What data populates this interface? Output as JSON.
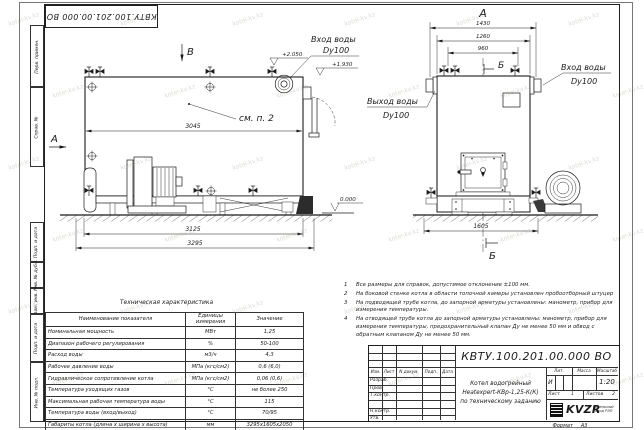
{
  "watermark": "kotel-kv.kz",
  "corner_stamp": "КВТУ.100.201.00.000 ВО",
  "margin_labels": {
    "perv_primen": "Перв. примен.",
    "sprav_no": "Справ. №",
    "podp_data_1": "Подп. и дата",
    "inv_dubl": "Инв. № дубл.",
    "vzam_inv": "Взам. инв. №",
    "podp_data_2": "Подп. и дата",
    "inv_podl": "Инв. № подл."
  },
  "drawing": {
    "left_view": {
      "section_top": "В",
      "section_side": "А",
      "callout": "см. п. 2",
      "dim_width": "3045",
      "dim_base": "3125",
      "dim_total": "3295",
      "level_top": "+2.050",
      "level_pipe": "+1.930",
      "inlet_label": "Вход воды",
      "inlet_dn": "Dy100"
    },
    "right_view": {
      "view_label": "А",
      "dim_overall": "1430",
      "dim_body": "1260",
      "dim_inner": "960",
      "dim_base": "1605",
      "section_top": "Б",
      "section_bottom": "Б",
      "inlet_label": "Вход воды",
      "inlet_dn": "Dy100",
      "outlet_label": "Выход воды",
      "outlet_dn": "Dy100"
    },
    "level_zero": "0.000"
  },
  "notes": {
    "items": [
      {
        "num": "1",
        "text": "Все размеры для справок, допустимое отклонение ±100 мм."
      },
      {
        "num": "2",
        "text": "На боковой стенке котла в области топочной камеры установлен пробоотборный штуцер"
      },
      {
        "num": "3",
        "text": "На подводящей трубе котла, до запорной арматуры установлены: манометр, прибор для измерения температуры."
      },
      {
        "num": "4",
        "text": "На отводящей трубе котла до запорной арматуры установлены: манометр, прибор для измерения температуры, предохранительный клапан Ду не менее 50 мм и обвод с обратным клапаном Ду не менее 50 мм."
      }
    ]
  },
  "tech_table": {
    "title": "Техническая характеристика",
    "headers": [
      "Наименование показателя",
      "Единицы измерения",
      "Значение"
    ],
    "rows": [
      [
        "Номинальная мощность",
        "МВт",
        "1,25"
      ],
      [
        "Диапазон рабочего регулирования",
        "%",
        "50-100"
      ],
      [
        "Расход воды",
        "м3/ч",
        "4,3"
      ],
      [
        "Рабочее давление воды",
        "МПа (кгс/см2)",
        "0,6 (6,0)"
      ],
      [
        "Гидравлическое сопротивление котла",
        "МПа (кгс/см2)",
        "0,06 (0,6)"
      ],
      [
        "Температура уходящих газов",
        "°С",
        "не более 250"
      ],
      [
        "Максимальная рабочая температура воды",
        "°С",
        "115"
      ],
      [
        "Температура воды (вход/выход)",
        "°С",
        "70/95"
      ],
      [
        "Габариты котла (длина х ширина х высота)",
        "мм",
        "3295х1605х2050"
      ]
    ]
  },
  "title_block": {
    "doc_number": "КВТУ.100.201.00.000 ВО",
    "header_cells": [
      "Изм.",
      "Лист",
      "N докум.",
      "Подп.",
      "Дата"
    ],
    "sign_rows": [
      "Разраб.",
      "Пров.",
      "Т.контр.",
      "",
      "Н.контр.",
      "Утв."
    ],
    "description_lines": [
      "Котел водогрейный",
      "Heatexpert-КВр-1,25-К(К)",
      "по техническому заданию"
    ],
    "lit_header": "Лит.",
    "mass_header": "Масса",
    "scale_header": "Масштаб",
    "lit_value": "И",
    "scale_value": "1:20",
    "sheet_label": "Лист",
    "sheet_number": "1",
    "sheets_label": "Листов",
    "sheets_number": "2",
    "logo_text": "KVZR",
    "company_line1": "котельный",
    "company_line2": "завод РЭП",
    "format_label": "Формат",
    "format_value": "А3"
  }
}
